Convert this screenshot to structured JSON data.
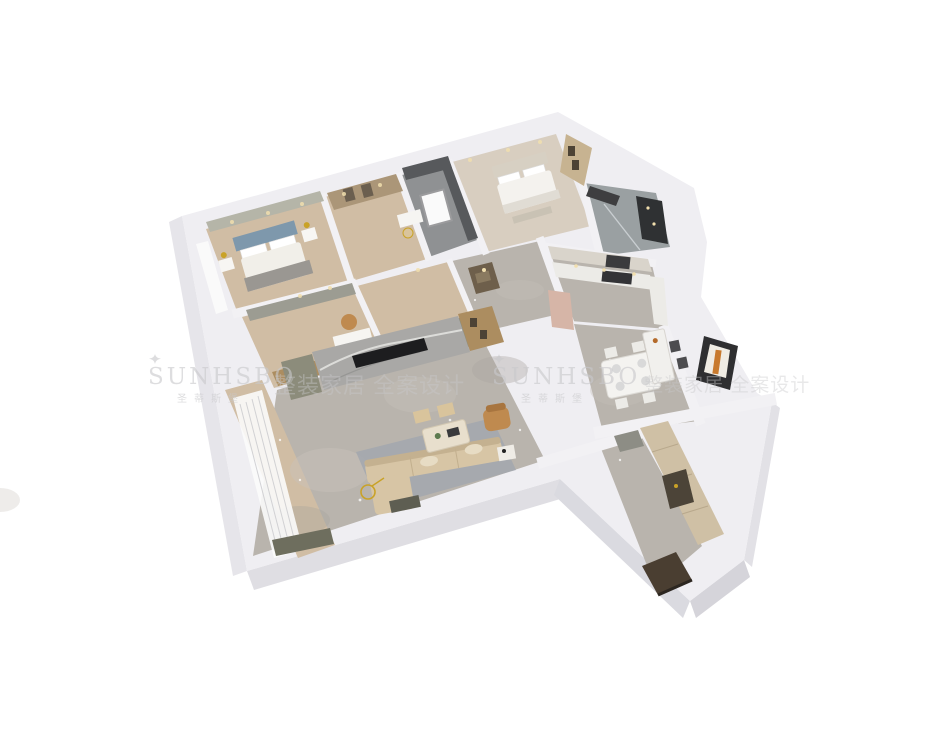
{
  "scene": {
    "type": "3d-isometric-apartment-floorplan-render",
    "background": "#ffffff",
    "rooms": [
      "master-bedroom",
      "walk-in-closet",
      "utility-room",
      "bedroom-2",
      "bathroom",
      "study",
      "hallway",
      "foyer",
      "kitchen",
      "dining-room",
      "living-room",
      "balcony",
      "entry-corridor"
    ]
  },
  "watermark": {
    "brand_latin": "SUNHSBO",
    "brand_cn": "圣蒂斯堡",
    "tagline_cn": "整装家居 全案设计",
    "icon": "crown-icon",
    "color": "#c9c9cb"
  },
  "palette": {
    "wall": "#efeef2",
    "wall_shadow": "#dddce1",
    "slab_side": "#d6d5da",
    "marble_floor": "#b9b4ad",
    "marble_light": "#cac5be",
    "wood_floor": "#d0bda4",
    "dark_wall": "#57595c",
    "rug": "#a2a7ae",
    "sofa": "#d7c5a5",
    "accent_chair": "#bf8a4f",
    "tv_wall_marble": "#a9a8a6",
    "cabinet_olive": "#8c8c7b",
    "shelf_wood": "#ac8d60",
    "headboard_blue": "#7e98ac",
    "gold": "#c9a227",
    "fridge_rose": "#d6b5a7",
    "entry_mat": "#4a3e31",
    "wm_color": "#c9c9cb"
  }
}
